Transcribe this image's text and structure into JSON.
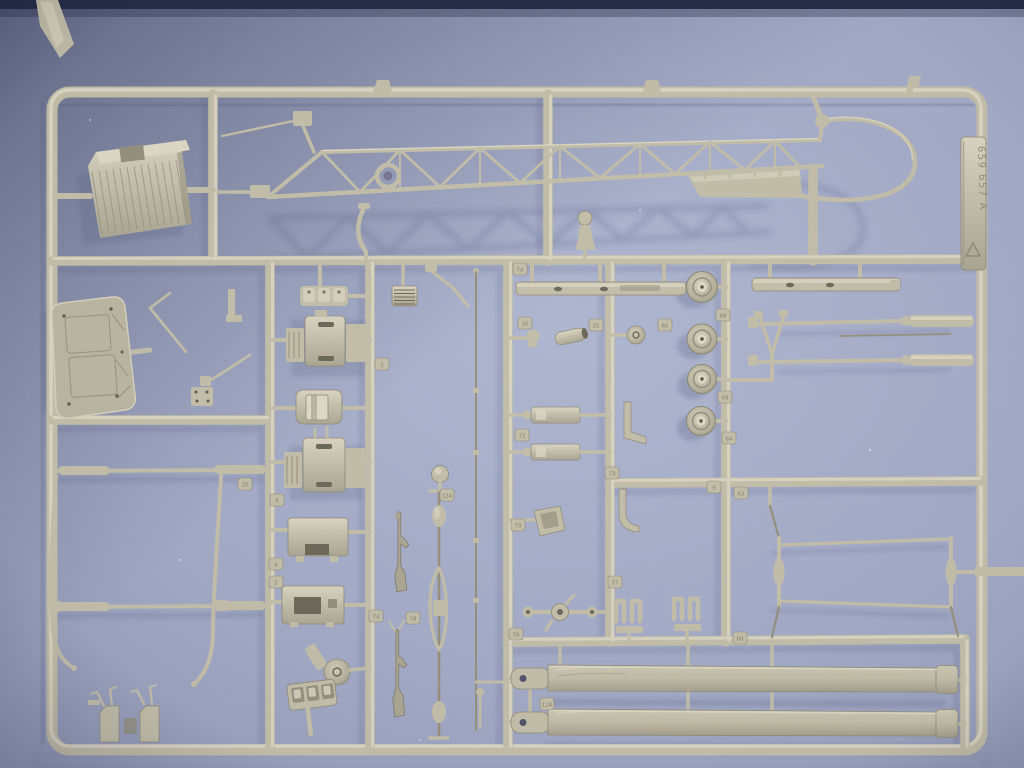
{
  "meta": {
    "description": "Photograph of an injection-moulded polystyrene model-kit sprue (parts tree) in grey-beige plastic lying on a blue-violet background",
    "type": "photograph"
  },
  "colors": {
    "bg": "#a3aac5",
    "bg_edge": "#8e95b1",
    "top_edge": "#232942",
    "plastic_light": "#ddd8c4",
    "plastic_mid": "#c2bda7",
    "plastic_dark": "#948f7b",
    "crevice": "#6b6757",
    "shadow": "#4f567a"
  },
  "sprue": {
    "plastic_color_name": "grey-beige styrene",
    "label_tag": {
      "text": "659 657 A",
      "symbol": "recycling-triangle"
    },
    "molded_part_tags": [
      {
        "label": "7A",
        "x": 513,
        "y": 263
      },
      {
        "label": "2",
        "x": 375,
        "y": 358
      },
      {
        "label": "20",
        "x": 238,
        "y": 478
      },
      {
        "label": "8",
        "x": 270,
        "y": 494
      },
      {
        "label": "4",
        "x": 269,
        "y": 558
      },
      {
        "label": "5",
        "x": 269,
        "y": 576
      },
      {
        "label": "74",
        "x": 369,
        "y": 610
      },
      {
        "label": "78",
        "x": 406,
        "y": 612
      },
      {
        "label": "12A",
        "x": 440,
        "y": 489
      },
      {
        "label": "12A",
        "x": 540,
        "y": 698
      },
      {
        "label": "79",
        "x": 511,
        "y": 519
      },
      {
        "label": "76",
        "x": 509,
        "y": 628
      },
      {
        "label": "72",
        "x": 515,
        "y": 429
      },
      {
        "label": "30",
        "x": 518,
        "y": 317
      },
      {
        "label": "25",
        "x": 589,
        "y": 319
      },
      {
        "label": "66",
        "x": 658,
        "y": 319
      },
      {
        "label": "68",
        "x": 716,
        "y": 309
      },
      {
        "label": "69",
        "x": 718,
        "y": 391
      },
      {
        "label": "64",
        "x": 722,
        "y": 432
      },
      {
        "label": "73",
        "x": 605,
        "y": 467
      },
      {
        "label": "77",
        "x": 608,
        "y": 576
      },
      {
        "label": "9",
        "x": 707,
        "y": 481
      },
      {
        "label": "63",
        "x": 734,
        "y": 487
      },
      {
        "label": "60",
        "x": 733,
        "y": 632
      }
    ],
    "visible_parts": [
      "lattice tail boom with tail fin and tail-rotor guard ring",
      "ribbed engine block",
      "cabin floor panel with engraved frames",
      "two ribbed gearbox housings",
      "seat pan",
      "instrument boxes",
      "radiator grille",
      "four road wheels with hubs",
      "landing skid cross tubes with curved legs",
      "two long main rotor blades with root fittings",
      "tail rotor drive shaft with couplings",
      "two rifle/machine-gun parts",
      "thin antenna mast",
      "fork strut and long control rods",
      "rotor hub with arms",
      "pedal U-brackets",
      "exhaust cylinder and pulley",
      "moulded part-number tabs",
      "manufacturer number tab 659 657 A"
    ]
  }
}
